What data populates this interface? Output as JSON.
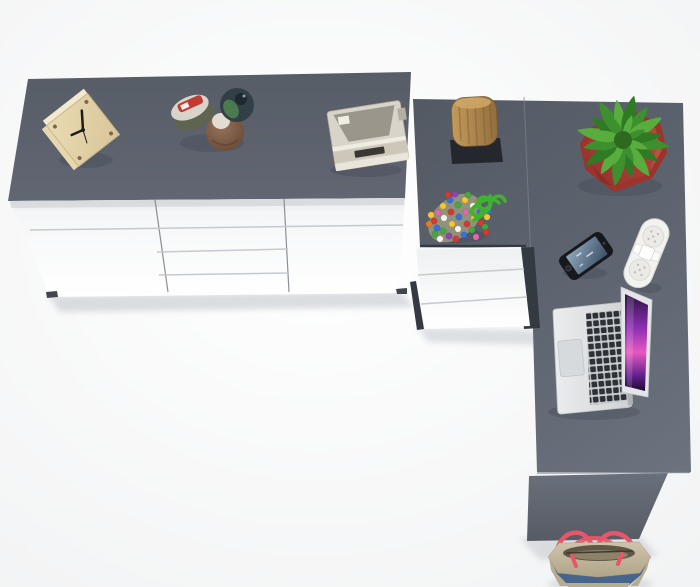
{
  "meta": {
    "alt": "Top view 3D render of a grey and white corner desk with sideboard, drawer pedestal and accessories on a white floor"
  },
  "colors": {
    "background": "#ffffff",
    "floor_edge": "#f1f2f3",
    "top_a": "#575d67",
    "top_b": "#616672",
    "desk_a": "#545a64",
    "desk_b": "#5e646f",
    "desk_c": "#6c727e",
    "panel_a": "#6a707b",
    "panel_b": "#565b64",
    "front_a": "#e7e9ec",
    "front_b": "#ffffff",
    "seam": "#8a9097",
    "drawer_line": "#c6c9cd",
    "edge_dark": "#343a41",
    "foot": "#41464d",
    "floor_shadow": "#b9bdc3",
    "shadow": "#3d434e",
    "wood_a": "#eadbb4",
    "wood_b": "#d9c598",
    "wood_side": "#f3e9cf",
    "wood_side2": "#e7d6ae",
    "screw": "#7a6848",
    "hand_black": "#1c1c1c",
    "fig_cream": "#d8d4cb",
    "fig_red": "#c23a34",
    "fig_olive": "#5f6450",
    "fig_brown_a": "#97735a",
    "fig_brown_b": "#674a36",
    "fig_cap": "#e3ddd1",
    "fig_dark": "#333f47",
    "fig_green": "#4c7a50",
    "fig_dark_cap": "#1e282e",
    "camera_body": "#d9d4c9",
    "camera_panel": "#9b968c",
    "camera_front": "#cdc7ba",
    "camera_slot": "#3a3631",
    "camera_light": "#efece3",
    "tray": "#24282e",
    "stump_a": "#c29a5c",
    "stump_b": "#936f3e",
    "stump_streak": "#7c5630",
    "stump_top": "#cfa868",
    "pouch_body": "#96987f",
    "cord_green": "#3db32e",
    "pot_a": "#c04b41",
    "pot_b": "#8f2f2a",
    "pot_shade": "#7d2a25",
    "pot_hi": "#d25a4e",
    "leaf_dark": "#2f7a24",
    "leaf_mid": "#3e8f2e",
    "leaf_light": "#58ad3c",
    "plant_center": "#2c6b1f",
    "phone_body": "#16181c",
    "screen_a": "#8fa6ba",
    "screen_b": "#3c5068",
    "speaker_white": "#f2f2f0",
    "speaker_grille": "#eceae6",
    "speaker_dot": "#b9b7b0",
    "base_a": "#ecedee",
    "base_b": "#ced1d3",
    "keydeck": "#c8cbcd",
    "key_dark": "#2e3136",
    "trackpad": "#d7dadc",
    "bezel": "#e3e5e6",
    "hinge": "#aeb2b5",
    "disp_0": "#2c1242",
    "disp_1": "#8d2fb3",
    "disp_2": "#e757c1",
    "disp_3": "#5d1f8a",
    "disp_4": "#1d0b2e",
    "bag_blue": "#47648a",
    "bag_khaki": "#c3b79c",
    "bag_khaki2": "#b7ab90",
    "bag_open": "#5f5847",
    "bag_open2": "#8d8169",
    "handle_red": "#e8566b"
  },
  "items": {
    "pouch": {
      "palette": [
        "#d63832",
        "#3a6fd8",
        "#f2c534",
        "#43a83f",
        "#e266ae",
        "#f7f3ea",
        "#8e44ad",
        "#e07b2a"
      ],
      "beads": [
        [
          434,
          221,
          0
        ],
        [
          438,
          213,
          4
        ],
        [
          437,
          228,
          1
        ],
        [
          443,
          206,
          2
        ],
        [
          444,
          218,
          5
        ],
        [
          443,
          231,
          3
        ],
        [
          450,
          200,
          1
        ],
        [
          451,
          212,
          0
        ],
        [
          452,
          224,
          2
        ],
        [
          449,
          236,
          6
        ],
        [
          458,
          205,
          3
        ],
        [
          459,
          217,
          1
        ],
        [
          458,
          229,
          5
        ],
        [
          456,
          239,
          0
        ],
        [
          465,
          200,
          2
        ],
        [
          466,
          212,
          4
        ],
        [
          467,
          224,
          0
        ],
        [
          464,
          235,
          1
        ],
        [
          473,
          206,
          5
        ],
        [
          474,
          218,
          2
        ],
        [
          472,
          230,
          3
        ],
        [
          480,
          212,
          1
        ],
        [
          481,
          223,
          0
        ],
        [
          479,
          201,
          7
        ],
        [
          487,
          217,
          2
        ],
        [
          485,
          227,
          3
        ],
        [
          431,
          215,
          2
        ],
        [
          440,
          239,
          5
        ],
        [
          448,
          195,
          0
        ],
        [
          468,
          195,
          3
        ],
        [
          476,
          237,
          4
        ],
        [
          489,
          211,
          1
        ],
        [
          435,
          234,
          3
        ],
        [
          455,
          194,
          6
        ],
        [
          486,
          232,
          0
        ],
        [
          429,
          224,
          7
        ]
      ]
    },
    "plant": {
      "leaves": [
        [
          8,
          1.15,
          "leaf_mid"
        ],
        [
          31,
          1.0,
          "leaf_dark"
        ],
        [
          54,
          1.1,
          "leaf_light"
        ],
        [
          77,
          0.95,
          "leaf_dark"
        ],
        [
          100,
          1.15,
          "leaf_mid"
        ],
        [
          123,
          1.0,
          "leaf_light"
        ],
        [
          146,
          1.1,
          "leaf_dark"
        ],
        [
          169,
          1.0,
          "leaf_mid"
        ],
        [
          192,
          1.15,
          "leaf_light"
        ],
        [
          215,
          0.95,
          "leaf_dark"
        ],
        [
          238,
          1.1,
          "leaf_mid"
        ],
        [
          261,
          1.0,
          "leaf_light"
        ],
        [
          284,
          1.12,
          "leaf_dark"
        ],
        [
          307,
          1.0,
          "leaf_mid"
        ],
        [
          330,
          1.1,
          "leaf_light"
        ],
        [
          353,
          0.95,
          "leaf_dark"
        ],
        [
          20,
          0.65,
          "leaf_light"
        ],
        [
          65,
          0.6,
          "leaf_mid"
        ],
        [
          110,
          0.65,
          "leaf_light"
        ],
        [
          155,
          0.6,
          "leaf_mid"
        ],
        [
          200,
          0.65,
          "leaf_light"
        ],
        [
          245,
          0.6,
          "leaf_mid"
        ],
        [
          290,
          0.65,
          "leaf_light"
        ],
        [
          335,
          0.6,
          "leaf_mid"
        ]
      ]
    }
  }
}
